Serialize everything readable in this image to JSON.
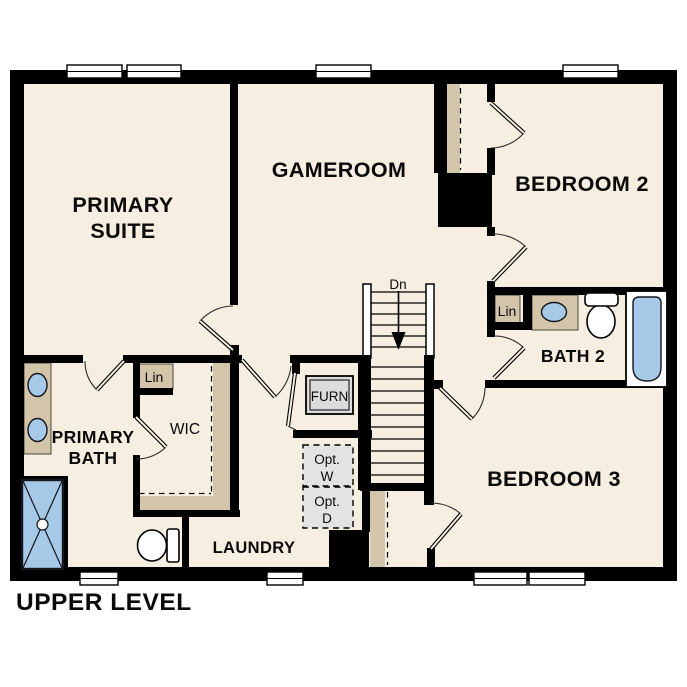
{
  "plan": {
    "title": "UPPER LEVEL",
    "colors": {
      "room_fill": "#f5eee1",
      "wall": "#000000",
      "closet_tan": "#d3c5a9",
      "fixture_blue": "#a7c9e8",
      "equipment_gray": "#dcdcdc",
      "optional_gray": "#e3e3e3",
      "background": "#ffffff"
    },
    "rooms": {
      "primary_suite": {
        "line1": "PRIMARY",
        "line2": "SUITE"
      },
      "gameroom": {
        "label": "GAMEROOM"
      },
      "bedroom_2": {
        "label": "BEDROOM 2"
      },
      "bath_2": {
        "label": "BATH 2"
      },
      "bedroom_3": {
        "label": "BEDROOM 3"
      },
      "primary_bath": {
        "line1": "PRIMARY",
        "line2": "BATH"
      },
      "wic": {
        "label": "WIC"
      },
      "laundry": {
        "label": "LAUNDRY"
      }
    },
    "annotations": {
      "stairs_direction": "Dn",
      "linen_primary": "Lin",
      "linen_bath2": "Lin",
      "furnace": "FURN",
      "optional_washer": {
        "line1": "Opt.",
        "line2": "W"
      },
      "optional_dryer": {
        "line1": "Opt.",
        "line2": "D"
      }
    }
  }
}
